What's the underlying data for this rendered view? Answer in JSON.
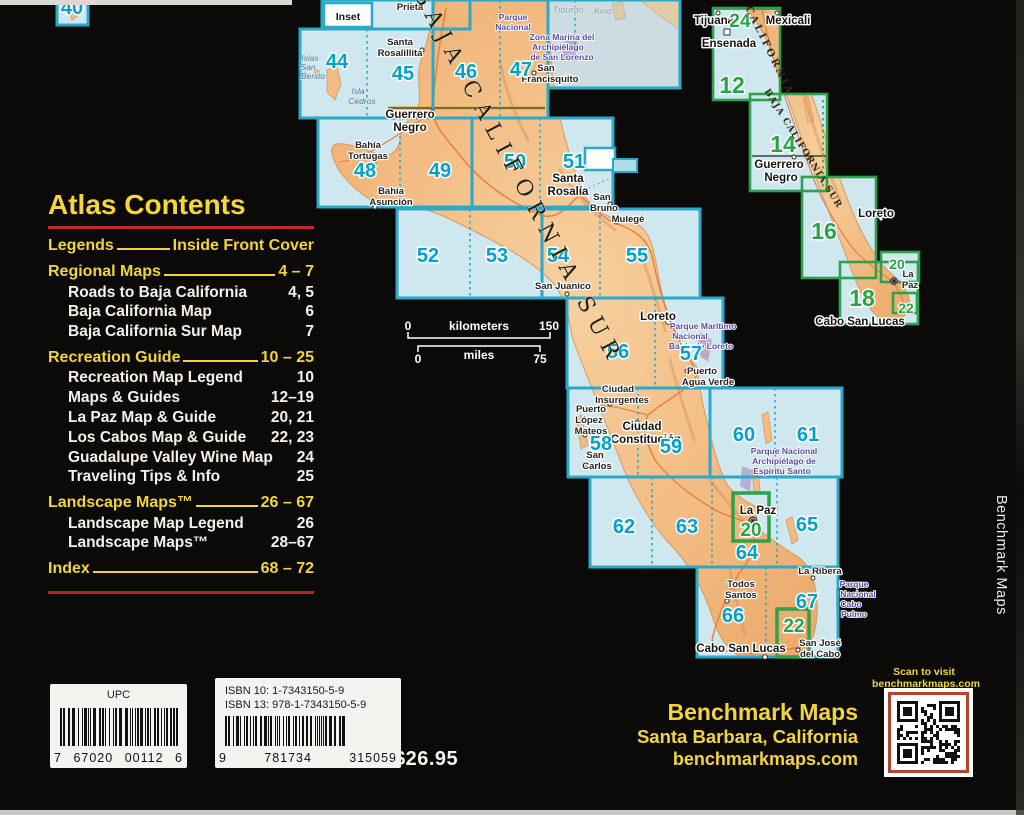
{
  "toc": {
    "title": "Atlas Contents",
    "rows": [
      {
        "label": "Legends",
        "pages": "Inside Front Cover",
        "style": "h"
      },
      {
        "label": "Regional Maps",
        "pages": "4 – 7",
        "style": "h"
      },
      {
        "label": "Roads to Baja California",
        "pages": "4, 5",
        "style": "s"
      },
      {
        "label": "Baja California Map",
        "pages": "6",
        "style": "s"
      },
      {
        "label": "Baja California Sur Map",
        "pages": "7",
        "style": "s"
      },
      {
        "label": "Recreation Guide",
        "pages": "10 – 25",
        "style": "h"
      },
      {
        "label": "Recreation Map Legend",
        "pages": "10",
        "style": "s"
      },
      {
        "label": "Maps & Guides",
        "pages": "12–19",
        "style": "s"
      },
      {
        "label": "La Paz Map & Guide",
        "pages": "20, 21",
        "style": "s"
      },
      {
        "label": "Los Cabos Map & Guide",
        "pages": "22, 23",
        "style": "s"
      },
      {
        "label": "Guadalupe Valley Wine Map",
        "pages": "24",
        "style": "s"
      },
      {
        "label": "Traveling Tips & Info",
        "pages": "25",
        "style": "s"
      },
      {
        "label": "Landscape Maps™",
        "pages": "26 – 67",
        "style": "h"
      },
      {
        "label": "Landscape Map Legend",
        "pages": "26",
        "style": "s"
      },
      {
        "label": "Landscape Maps™",
        "pages": "28–67",
        "style": "s"
      },
      {
        "label": "Index",
        "pages": "68 – 72",
        "style": "h"
      }
    ]
  },
  "barcodes": {
    "upc": {
      "label": "UPC",
      "digits": [
        "7",
        "67020",
        "00112",
        "6"
      ]
    },
    "isbn": {
      "line1": "ISBN 10: 1-7343150-5-9",
      "line2": "ISBN 13:  978-1-7343150-5-9",
      "digits": [
        "9",
        "781734",
        "315059"
      ]
    }
  },
  "price": "$26.95",
  "publisher": {
    "name": "Benchmark Maps",
    "city": "Santa Barbara, California",
    "website": "benchmarkmaps.com",
    "spine": "Benchmark Maps",
    "qr_caption_line1": "Scan to visit",
    "qr_caption_line2": "benchmarkmaps.com"
  },
  "colors": {
    "accent_yellow": "#f2d43c",
    "rule_red": "#c1272d",
    "grid_cyan": "#2aa9c9",
    "number_cyan": "#00a2c9",
    "grid_green": "#2da14b",
    "sea": "#cfe7ef",
    "land": "#f1b980",
    "park_purple": "#5a48a0",
    "qr_border": "#b5442d"
  },
  "map": {
    "labels": [
      {
        "t": "Inset",
        "x": 348,
        "y": 20,
        "c": "inlb"
      },
      {
        "t": "Prieta",
        "x": 410,
        "y": 10,
        "c": "ct"
      },
      {
        "t": "Parque",
        "x": 513,
        "y": 20,
        "c": "pk"
      },
      {
        "t": "Nacional",
        "x": 513,
        "y": 30,
        "c": "pk"
      },
      {
        "t": "Zona Marina del",
        "x": 562,
        "y": 40,
        "c": "pk"
      },
      {
        "t": "Archipiélago",
        "x": 558,
        "y": 50,
        "c": "pk"
      },
      {
        "t": "de San Lorenzo",
        "x": 562,
        "y": 60,
        "c": "pk"
      },
      {
        "t": "Tiburón",
        "x": 568,
        "y": 13,
        "c": "wt2"
      },
      {
        "t": "Kino",
        "x": 603,
        "y": 14,
        "c": "wt2"
      },
      {
        "t": "Santa",
        "x": 400,
        "y": 45,
        "c": "ct"
      },
      {
        "t": "Rosalillita",
        "x": 400,
        "y": 56,
        "c": "ct"
      },
      {
        "t": "Islas",
        "x": 310,
        "y": 61,
        "c": "wt"
      },
      {
        "t": "San",
        "x": 308,
        "y": 70,
        "c": "wt"
      },
      {
        "t": "Benito",
        "x": 313,
        "y": 79,
        "c": "wt"
      },
      {
        "t": "Isla",
        "x": 358,
        "y": 94,
        "c": "wt"
      },
      {
        "t": "Cedros",
        "x": 362,
        "y": 104,
        "c": "wt"
      },
      {
        "t": "San",
        "x": 546,
        "y": 71,
        "c": "ct"
      },
      {
        "t": "Francisquito",
        "x": 550,
        "y": 82,
        "c": "ct"
      },
      {
        "t": "44",
        "x": 337,
        "y": 68,
        "c": "nc"
      },
      {
        "t": "45",
        "x": 403,
        "y": 80,
        "c": "nc"
      },
      {
        "t": "46",
        "x": 466,
        "y": 78,
        "c": "nc"
      },
      {
        "t": "47",
        "x": 521,
        "y": 76,
        "c": "nc"
      },
      {
        "t": "40",
        "x": 72,
        "y": 14,
        "c": "nc"
      },
      {
        "t": "Guerrero",
        "x": 410,
        "y": 118,
        "c": "cb"
      },
      {
        "t": "Negro",
        "x": 410,
        "y": 131,
        "c": "cb"
      },
      {
        "t": "Bahía",
        "x": 368,
        "y": 148,
        "c": "ct"
      },
      {
        "t": "Tortugas",
        "x": 368,
        "y": 159,
        "c": "ct"
      },
      {
        "t": "48",
        "x": 365,
        "y": 177,
        "c": "nc"
      },
      {
        "t": "49",
        "x": 440,
        "y": 177,
        "c": "nc"
      },
      {
        "t": "50",
        "x": 515,
        "y": 168,
        "c": "nc"
      },
      {
        "t": "51",
        "x": 574,
        "y": 168,
        "c": "nc"
      },
      {
        "t": "Bahía",
        "x": 391,
        "y": 194,
        "c": "ct"
      },
      {
        "t": "Asunción",
        "x": 391,
        "y": 205,
        "c": "ct"
      },
      {
        "t": "Santa",
        "x": 568,
        "y": 182,
        "c": "cb"
      },
      {
        "t": "Rosalía",
        "x": 568,
        "y": 195,
        "c": "cb"
      },
      {
        "t": "San",
        "x": 602,
        "y": 200,
        "c": "ct"
      },
      {
        "t": "Bruno",
        "x": 604,
        "y": 211,
        "c": "ct"
      },
      {
        "t": "Mulegé",
        "x": 628,
        "y": 222,
        "c": "ct"
      },
      {
        "t": "52",
        "x": 428,
        "y": 262,
        "c": "nc"
      },
      {
        "t": "53",
        "x": 497,
        "y": 262,
        "c": "nc"
      },
      {
        "t": "54",
        "x": 558,
        "y": 262,
        "c": "nc"
      },
      {
        "t": "55",
        "x": 637,
        "y": 262,
        "c": "nc"
      },
      {
        "t": "San Juanico",
        "x": 563,
        "y": 289,
        "c": "ct"
      },
      {
        "t": "Loreto",
        "x": 658,
        "y": 320,
        "c": "cb"
      },
      {
        "t": "Parque Marítimo",
        "x": 703,
        "y": 329,
        "c": "pk"
      },
      {
        "t": "Nacional",
        "x": 690,
        "y": 339,
        "c": "pk"
      },
      {
        "t": "Bahía de Loreto",
        "x": 701,
        "y": 349,
        "c": "pk"
      },
      {
        "t": "56",
        "x": 618,
        "y": 358,
        "c": "nc"
      },
      {
        "t": "57",
        "x": 691,
        "y": 360,
        "c": "nc"
      },
      {
        "t": "Puerto",
        "x": 702,
        "y": 374,
        "c": "ct"
      },
      {
        "t": "Agua Verde",
        "x": 708,
        "y": 385,
        "c": "ct"
      },
      {
        "t": "Ciudad",
        "x": 618,
        "y": 392,
        "c": "ct"
      },
      {
        "t": "Insurgentes",
        "x": 622,
        "y": 403,
        "c": "ct"
      },
      {
        "t": "Puerto",
        "x": 591,
        "y": 412,
        "c": "ct"
      },
      {
        "t": "López",
        "x": 589,
        "y": 423,
        "c": "ct"
      },
      {
        "t": "Mateos",
        "x": 591,
        "y": 434,
        "c": "ct"
      },
      {
        "t": "Ciudad",
        "x": 642,
        "y": 430,
        "c": "cb"
      },
      {
        "t": "Constitución",
        "x": 646,
        "y": 443,
        "c": "cb"
      },
      {
        "t": "58",
        "x": 601,
        "y": 450,
        "c": "nc"
      },
      {
        "t": "59",
        "x": 671,
        "y": 453,
        "c": "nc"
      },
      {
        "t": "San",
        "x": 595,
        "y": 458,
        "c": "ct"
      },
      {
        "t": "Carlos",
        "x": 597,
        "y": 469,
        "c": "ct"
      },
      {
        "t": "60",
        "x": 744,
        "y": 441,
        "c": "nc"
      },
      {
        "t": "61",
        "x": 808,
        "y": 441,
        "c": "nc"
      },
      {
        "t": "Parque Nacional",
        "x": 784,
        "y": 454,
        "c": "pk"
      },
      {
        "t": "Archipiélago de",
        "x": 784,
        "y": 464,
        "c": "pk"
      },
      {
        "t": "Espíritu Santo",
        "x": 782,
        "y": 474,
        "c": "pk"
      },
      {
        "t": "La Paz",
        "x": 758,
        "y": 514,
        "c": "cb"
      },
      {
        "t": "20",
        "x": 751,
        "y": 536,
        "c": "ng"
      },
      {
        "t": "62",
        "x": 624,
        "y": 533,
        "c": "nc"
      },
      {
        "t": "63",
        "x": 687,
        "y": 533,
        "c": "nc"
      },
      {
        "t": "64",
        "x": 747,
        "y": 559,
        "c": "nc"
      },
      {
        "t": "65",
        "x": 807,
        "y": 531,
        "c": "nc"
      },
      {
        "t": "La Ribera",
        "x": 820,
        "y": 574,
        "c": "ct"
      },
      {
        "t": "Todos",
        "x": 741,
        "y": 587,
        "c": "ct"
      },
      {
        "t": "Santos",
        "x": 741,
        "y": 598,
        "c": "ct"
      },
      {
        "t": "Parque",
        "x": 854,
        "y": 587,
        "c": "pk"
      },
      {
        "t": "Nacional",
        "x": 858,
        "y": 597,
        "c": "pk"
      },
      {
        "t": "Cabo",
        "x": 851,
        "y": 607,
        "c": "pk"
      },
      {
        "t": "Pulmo",
        "x": 854,
        "y": 617,
        "c": "pk"
      },
      {
        "t": "66",
        "x": 733,
        "y": 622,
        "c": "nc"
      },
      {
        "t": "67",
        "x": 807,
        "y": 608,
        "c": "nc"
      },
      {
        "t": "22",
        "x": 794,
        "y": 632,
        "c": "ng"
      },
      {
        "t": "Cabo San Lucas",
        "x": 741,
        "y": 652,
        "c": "cb"
      },
      {
        "t": "San José",
        "x": 820,
        "y": 646,
        "c": "ct"
      },
      {
        "t": "del Cabo",
        "x": 820,
        "y": 657,
        "c": "ct"
      },
      {
        "t": "BAJA CALIFORNIA SUR",
        "x": 512,
        "y": 180,
        "c": "bcs",
        "r": 62
      },
      {
        "t": "0",
        "x": 408,
        "y": 330,
        "c": "sc"
      },
      {
        "t": "kilometers",
        "x": 479,
        "y": 330,
        "c": "sc"
      },
      {
        "t": "150",
        "x": 549,
        "y": 330,
        "c": "sc"
      },
      {
        "t": "0",
        "x": 418,
        "y": 363,
        "c": "sc"
      },
      {
        "t": "miles",
        "x": 479,
        "y": 359,
        "c": "sc"
      },
      {
        "t": "75",
        "x": 540,
        "y": 363,
        "c": "sc"
      },
      {
        "t": "Tijuana",
        "x": 714,
        "y": 24,
        "c": "cb"
      },
      {
        "t": "24",
        "x": 740,
        "y": 27,
        "c": "ng"
      },
      {
        "t": "Mexicali",
        "x": 788,
        "y": 24,
        "c": "cb"
      },
      {
        "t": "Ensenada",
        "x": 729,
        "y": 47,
        "c": "cb"
      },
      {
        "t": "BAJA CALIFORNIA",
        "x": 757,
        "y": 32,
        "c": "bcr",
        "r": 64
      },
      {
        "t": "12",
        "x": 732,
        "y": 93,
        "c": "ngb"
      },
      {
        "t": "14",
        "x": 783,
        "y": 152,
        "c": "ngb"
      },
      {
        "t": "Guerrero",
        "x": 779,
        "y": 168,
        "c": "cb"
      },
      {
        "t": "Negro",
        "x": 781,
        "y": 181,
        "c": "cb"
      },
      {
        "t": "BAJA CALIFORNIA SUR",
        "x": 801,
        "y": 150,
        "c": "bcr2",
        "r": 58
      },
      {
        "t": "16",
        "x": 824,
        "y": 239,
        "c": "ngb"
      },
      {
        "t": "Loreto",
        "x": 876,
        "y": 217,
        "c": "cb"
      },
      {
        "t": "20",
        "x": 897,
        "y": 269,
        "c": "ngs"
      },
      {
        "t": "La",
        "x": 908,
        "y": 277,
        "c": "ct"
      },
      {
        "t": "Paz",
        "x": 910,
        "y": 288,
        "c": "ct"
      },
      {
        "t": "18",
        "x": 862,
        "y": 306,
        "c": "ngb"
      },
      {
        "t": "22",
        "x": 906,
        "y": 313,
        "c": "ngs"
      },
      {
        "t": "Cabo San Lucas",
        "x": 860,
        "y": 325,
        "c": "cb"
      }
    ]
  }
}
